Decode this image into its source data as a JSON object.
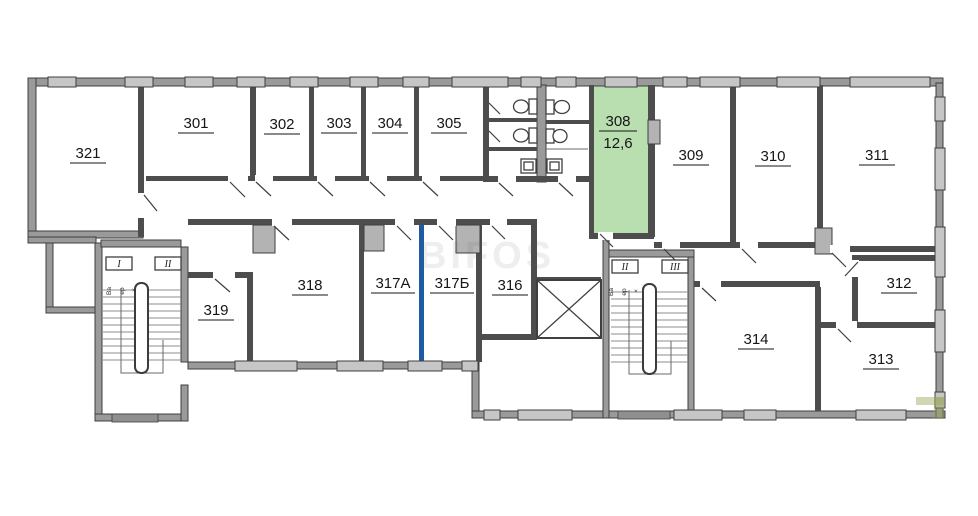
{
  "plan": {
    "watermark": "BIFOS",
    "highlight": {
      "room": "308",
      "area": "12,6"
    },
    "rooms": {
      "r301": {
        "label": "301"
      },
      "r302": {
        "label": "302"
      },
      "r303": {
        "label": "303"
      },
      "r304": {
        "label": "304"
      },
      "r305": {
        "label": "305"
      },
      "r308": {
        "label": "308",
        "area": "12,6"
      },
      "r309": {
        "label": "309"
      },
      "r310": {
        "label": "310"
      },
      "r311": {
        "label": "311"
      },
      "r312": {
        "label": "312"
      },
      "r313": {
        "label": "313"
      },
      "r314": {
        "label": "314"
      },
      "r316": {
        "label": "316"
      },
      "r317a": {
        "label": "317А"
      },
      "r317b": {
        "label": "317Б"
      },
      "r318": {
        "label": "318"
      },
      "r319": {
        "label": "319"
      },
      "r321": {
        "label": "321"
      }
    },
    "stairs": {
      "left": {
        "flights": [
          "I",
          "II"
        ],
        "side_text": [
          "Ва",
          "ер",
          "×"
        ]
      },
      "right": {
        "flights": [
          "II",
          "III"
        ],
        "side_text": [
          "Ва",
          "ер",
          "×"
        ]
      }
    },
    "colors": {
      "highlight_room_fill": "#b9dfb1",
      "highlight_wall": "#1d5ca3",
      "wall_dark": "#3f3f3f",
      "wall_fill": "#9a9a9a",
      "window_fill": "#c6c6c6"
    }
  }
}
